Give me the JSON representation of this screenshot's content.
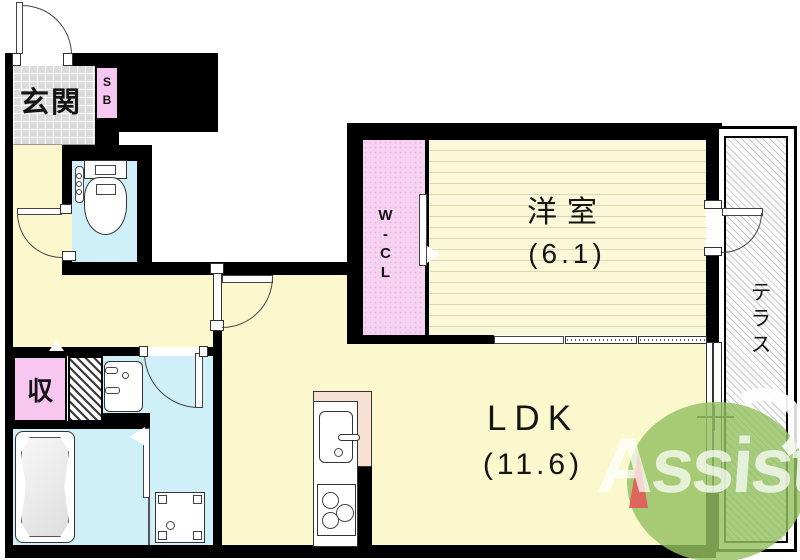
{
  "plan_title": "apartment-floor-plan",
  "rooms": {
    "genkan": {
      "label": "玄関"
    },
    "shoe_box": {
      "label": "SB"
    },
    "wcl": {
      "label": "W-CL"
    },
    "western_room": {
      "label": "洋室",
      "size": "(6.1)"
    },
    "ldk": {
      "label": "LDK",
      "size": "(11.6)"
    },
    "storage": {
      "label": "収"
    },
    "terrace": {
      "label": "テラス"
    }
  },
  "logo": {
    "text": "Assist"
  },
  "colors": {
    "wall": "#000000",
    "floor_yellow": "#fbf8cd",
    "wet_room_cyan": "#cff0f8",
    "storage_pink": "#f7c6f1",
    "wcl_pink": "#f7d3f3",
    "entrance_tile_gray": "#dcdcdc",
    "kitchen_peach": "#f6e1d2",
    "logo_green": "#94c161",
    "logo_accent_red": "#e45a5a"
  }
}
